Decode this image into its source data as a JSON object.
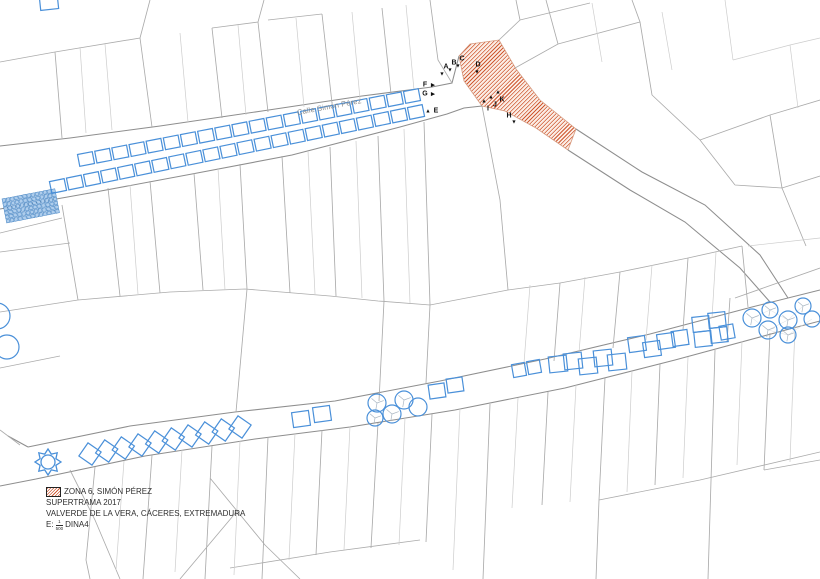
{
  "map": {
    "street_label": "Calle Simón Pérez",
    "markers": [
      {
        "label": "A",
        "x": 446,
        "y": 67,
        "tri": "down",
        "tx": 442,
        "ty": 75
      },
      {
        "label": "B",
        "x": 454,
        "y": 63,
        "tri": "down",
        "tx": 450,
        "ty": 71
      },
      {
        "label": "C",
        "x": 462,
        "y": 59,
        "tri": "down",
        "tx": 458,
        "ty": 67
      },
      {
        "label": "D",
        "x": 478,
        "y": 65,
        "tri": "down",
        "tx": 477,
        "ty": 73
      },
      {
        "label": "E",
        "x": 436,
        "y": 111,
        "tri": "up",
        "tx": 428,
        "ty": 112
      },
      {
        "label": "F",
        "x": 425,
        "y": 85,
        "tri": "right",
        "tx": 433,
        "ty": 86
      },
      {
        "label": "G",
        "x": 425,
        "y": 94,
        "tri": "right",
        "tx": 433,
        "ty": 95
      },
      {
        "label": "H",
        "x": 509,
        "y": 116,
        "tri": "down",
        "tx": 514,
        "ty": 123
      },
      {
        "label": "I",
        "x": 488,
        "y": 109,
        "tri": "up",
        "tx": 484,
        "ty": 102
      },
      {
        "label": "J",
        "x": 495,
        "y": 105,
        "tri": "up",
        "tx": 491,
        "ty": 98
      },
      {
        "label": "K",
        "x": 502,
        "y": 100,
        "tri": "up",
        "tx": 498,
        "ty": 93
      }
    ],
    "features": {
      "upper_rows": [
        {
          "x1": 86,
          "y1": 159,
          "x2": 412,
          "y2": 96,
          "count": 20,
          "w": 15,
          "h": 12
        },
        {
          "x1": 58,
          "y1": 186,
          "x2": 416,
          "y2": 112,
          "count": 22,
          "w": 15,
          "h": 12
        }
      ],
      "diamond_row": {
        "x1": 90,
        "y1": 454,
        "x2": 240,
        "y2": 427,
        "count": 10,
        "size": 16
      },
      "squares": [
        [
          301,
          419,
          17,
          15,
          -8
        ],
        [
          322,
          414,
          17,
          15,
          -8
        ],
        [
          437,
          391,
          16,
          14,
          -8
        ],
        [
          455,
          385,
          16,
          14,
          -8
        ],
        [
          519,
          370,
          13,
          13,
          -10
        ],
        [
          534,
          367,
          13,
          13,
          -10
        ],
        [
          558,
          364,
          18,
          16,
          -6
        ],
        [
          573,
          361,
          18,
          16,
          -6
        ],
        [
          588,
          366,
          18,
          16,
          -6
        ],
        [
          603,
          358,
          18,
          16,
          -6
        ],
        [
          617,
          362,
          18,
          16,
          -6
        ],
        [
          637,
          344,
          17,
          15,
          -8
        ],
        [
          652,
          349,
          17,
          15,
          -8
        ],
        [
          666,
          341,
          17,
          15,
          -8
        ],
        [
          680,
          338,
          16,
          15,
          -8
        ],
        [
          701,
          324,
          17,
          15,
          -6
        ],
        [
          717,
          320,
          17,
          15,
          -6
        ],
        [
          703,
          339,
          17,
          15,
          -6
        ],
        [
          719,
          335,
          17,
          15,
          -6
        ],
        [
          727,
          332,
          14,
          14,
          -10
        ],
        [
          49,
          3,
          18,
          13,
          -6
        ]
      ],
      "trees": [
        [
          377,
          403,
          9,
          1
        ],
        [
          375,
          418,
          8,
          1
        ],
        [
          392,
          414,
          9,
          1
        ],
        [
          404,
          400,
          9,
          1
        ],
        [
          418,
          407,
          9,
          0
        ],
        [
          752,
          318,
          9,
          1
        ],
        [
          770,
          310,
          8,
          1
        ],
        [
          788,
          320,
          9,
          1
        ],
        [
          803,
          306,
          8,
          1
        ],
        [
          768,
          330,
          9,
          1
        ],
        [
          788,
          335,
          8,
          1
        ],
        [
          812,
          319,
          8,
          0
        ],
        [
          -3,
          316,
          13,
          0
        ],
        [
          7,
          347,
          12,
          0
        ]
      ],
      "grid_block": {
        "x": 2,
        "y": 199,
        "rows": 6,
        "cols": 13,
        "cell": 4.2,
        "size": 3.4,
        "angle": -11
      },
      "fountain": {
        "cx": 48,
        "cy": 462,
        "outer": 13,
        "inner": 8.6,
        "circle": 7
      }
    }
  },
  "legend": {
    "zone": "ZONA 6, SIMÓN PÉREZ",
    "project": "SUPERTRAMA 2017",
    "location": "VALVERDE DE LA VERA, CÁCERES, EXTREMADURA",
    "scale_prefix": "E:",
    "scale_numerator": "1",
    "scale_denominator": "500",
    "scale_suffix": "DINA4"
  },
  "colors": {
    "parcel_major": "#8e8e8e",
    "parcel_medium": "#ababab",
    "parcel_minor": "#cccccc",
    "feature_blue": "#4a90d9",
    "zone_hatch": "#cf5a33",
    "text_dark": "#2e2e2e",
    "street_label_gray": "#8a8a8a"
  }
}
